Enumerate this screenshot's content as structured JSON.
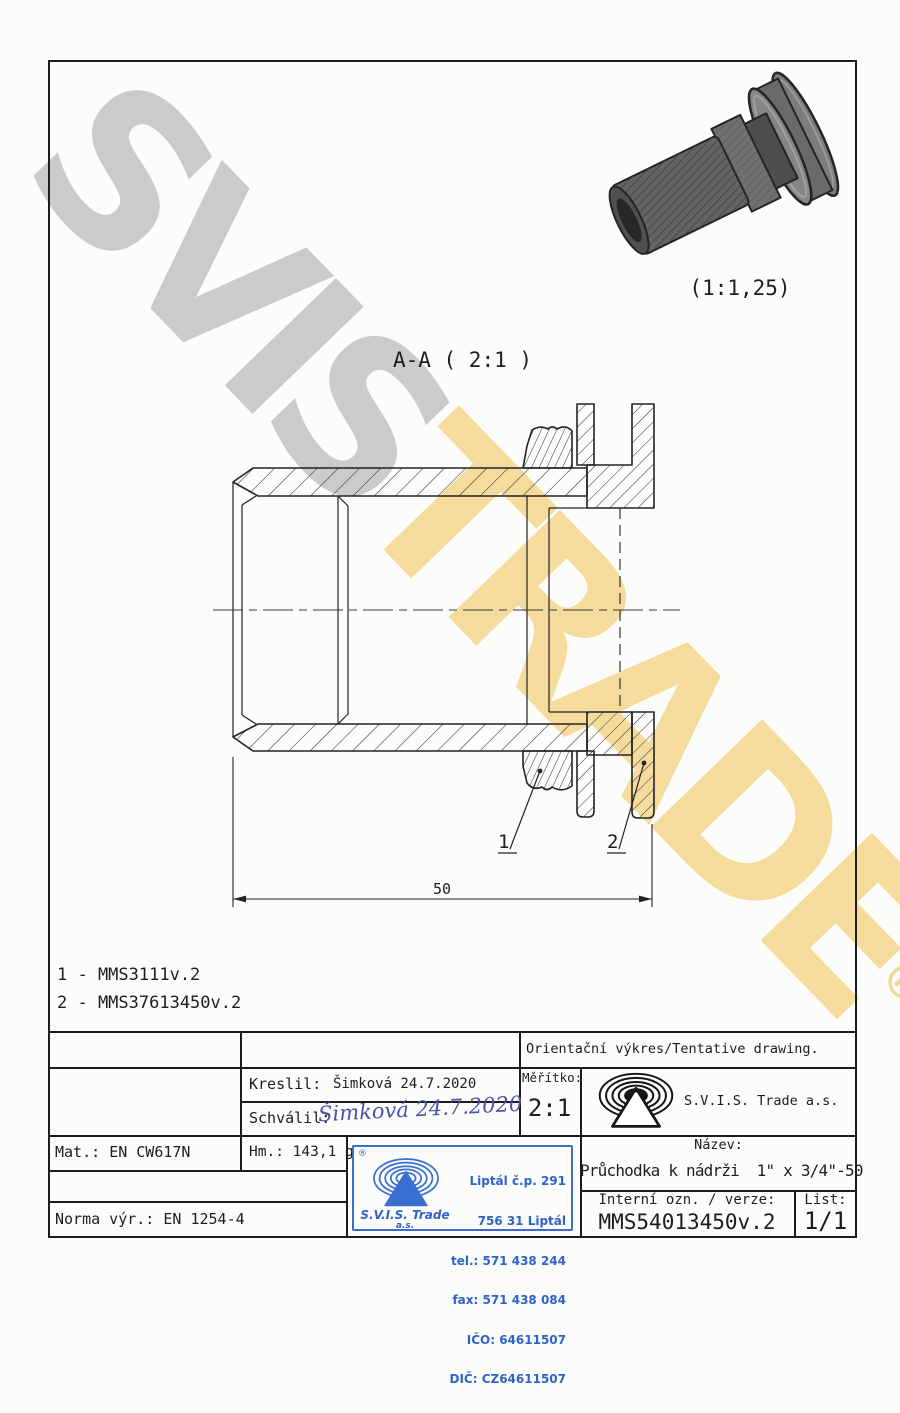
{
  "watermark": {
    "part1": "SVIS",
    "part2": "TRADE",
    "registered": "®"
  },
  "preview": {
    "scale_label": "(1:1,25)"
  },
  "section_view": {
    "title": "A-A ( 2:1 )",
    "dimension_50": "50",
    "balloon_1": "1",
    "balloon_2": "2"
  },
  "parts_list": {
    "line1": "1 - MMS3111v.2",
    "line2": "2 - MMS37613450v.2"
  },
  "title_block": {
    "orientacni": "Orientační výkres/Tentative drawing.",
    "kreslil_label": "Kreslil:",
    "kreslil_value": "Šimková 24.7.2020",
    "schvalil_label": "Schválil:",
    "schvalil_signature": "Šimková 24.7.2020",
    "meritko_label": "Měřítko:",
    "meritko_value": "2:1",
    "company_name": "S.V.I.S. Trade a.s.",
    "mat_label": "Mat.:",
    "mat_value": "EN CW617N",
    "hm_label": "Hm.:",
    "hm_value": "143,1 g",
    "norma_label": "Norma výr.:",
    "norma_value": "EN 1254-4",
    "nazev_label": "Název:",
    "nazev_value": "Průchodka k nádrži  1\" x 3/4\"-50",
    "interni_label": "Interní ozn. / verze:",
    "interni_value": "MMS54013450v.2",
    "list_label": "List:",
    "list_value": "1/1"
  },
  "stamp": {
    "registered": "®",
    "line1": "Liptál č.p. 291",
    "line2": "756 31 Liptál",
    "line3": "tel.: 571 438 244",
    "line4": "fax: 571 438 084",
    "line5": "IČO: 64611507",
    "line6": "DIČ: CZ64611507",
    "company": "S.V.I.S. Trade",
    "company_suffix": "a.s."
  },
  "colors": {
    "stamp_blue": "#2f63c8",
    "signature_blue": "#4a51a8",
    "watermark_gray": "#cbcbcb",
    "watermark_yellow": "#f5dc9d",
    "line_dark": "#232323"
  }
}
